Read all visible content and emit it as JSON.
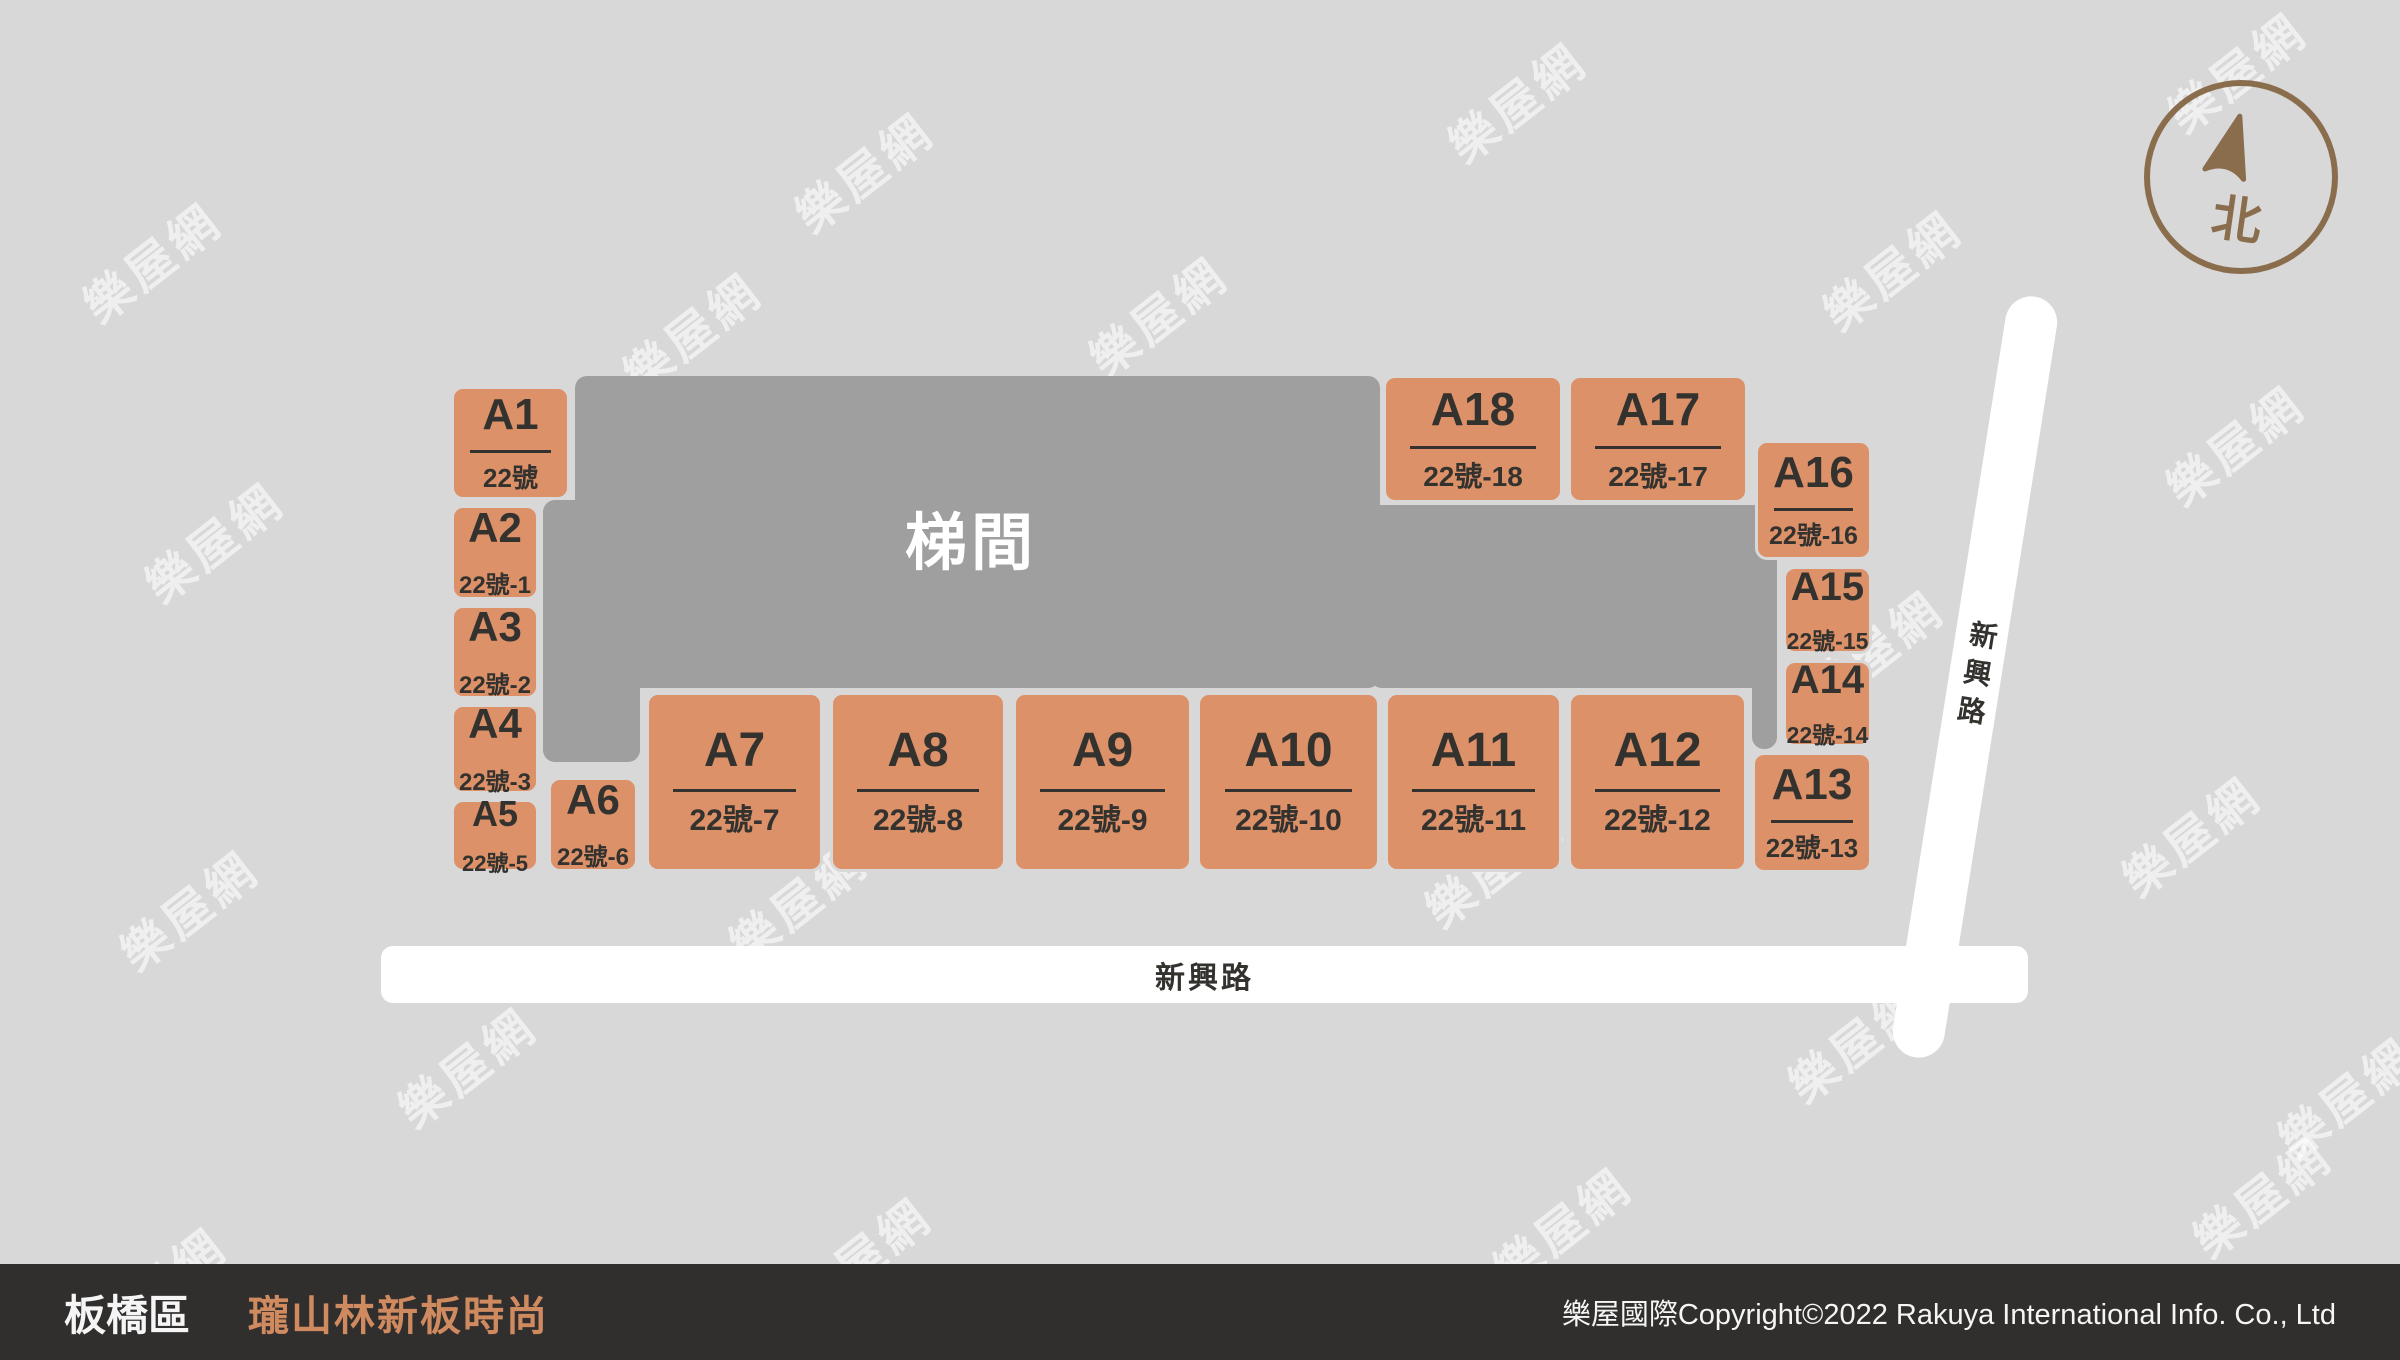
{
  "colors": {
    "bg": "#d8d8d8",
    "stair_fill": "#9f9f9f",
    "stair_text": "#ffffff",
    "unit_fill": "#dd9168",
    "unit_text": "#33322f",
    "road_fill": "#ffffff",
    "road_text": "#33322f",
    "compass_brown": "#8a6d4c",
    "footer_bg": "#302f2d",
    "footer_text": "#f5f5f5",
    "footer_project": "#cf8a60",
    "watermark": "rgba(255,255,255,0.6)"
  },
  "map": {
    "stairwell_label": "梯間",
    "road_bottom": {
      "label": "新興路"
    },
    "road_right": {
      "label": "新興路"
    },
    "compass": {
      "north_label": "北"
    },
    "watermark": {
      "text": "樂屋網",
      "positions": [
        [
          150,
          260
        ],
        [
          862,
          170
        ],
        [
          1515,
          100
        ],
        [
          2235,
          70
        ],
        [
          1890,
          268
        ],
        [
          1156,
          314
        ],
        [
          690,
          330
        ],
        [
          212,
          540
        ],
        [
          2233,
          443
        ],
        [
          1872,
          648
        ],
        [
          187,
          908
        ],
        [
          796,
          900
        ],
        [
          1492,
          865
        ],
        [
          2189,
          834
        ],
        [
          465,
          1065
        ],
        [
          1855,
          1040
        ],
        [
          2345,
          1095
        ],
        [
          155,
          1285
        ],
        [
          860,
          1255
        ],
        [
          1560,
          1225
        ],
        [
          2260,
          1195
        ]
      ]
    },
    "units": [
      {
        "id": "A1",
        "address": "22號",
        "x": 451,
        "y": 386,
        "w": 119,
        "h": 114,
        "fs": 44,
        "afs": 26
      },
      {
        "id": "A2",
        "address": "22號-1",
        "x": 451,
        "y": 505,
        "w": 88,
        "h": 95,
        "fs": 42,
        "afs": 24
      },
      {
        "id": "A3",
        "address": "22號-2",
        "x": 451,
        "y": 605,
        "w": 88,
        "h": 94,
        "fs": 42,
        "afs": 24
      },
      {
        "id": "A4",
        "address": "22號-3",
        "x": 451,
        "y": 704,
        "w": 88,
        "h": 90,
        "fs": 42,
        "afs": 24
      },
      {
        "id": "A5",
        "address": "22號-5",
        "x": 451,
        "y": 799,
        "w": 88,
        "h": 73,
        "fs": 36,
        "afs": 22
      },
      {
        "id": "A6",
        "address": "22號-6",
        "x": 548,
        "y": 777,
        "w": 90,
        "h": 95,
        "fs": 42,
        "afs": 24
      },
      {
        "id": "A7",
        "address": "22號-7",
        "x": 646,
        "y": 692,
        "w": 177,
        "h": 180,
        "fs": 48,
        "afs": 30
      },
      {
        "id": "A8",
        "address": "22號-8",
        "x": 830,
        "y": 692,
        "w": 176,
        "h": 180,
        "fs": 48,
        "afs": 30
      },
      {
        "id": "A9",
        "address": "22號-9",
        "x": 1013,
        "y": 692,
        "w": 179,
        "h": 180,
        "fs": 48,
        "afs": 30
      },
      {
        "id": "A10",
        "address": "22號-10",
        "x": 1197,
        "y": 692,
        "w": 183,
        "h": 180,
        "fs": 48,
        "afs": 30
      },
      {
        "id": "A11",
        "address": "22號-11",
        "x": 1385,
        "y": 692,
        "w": 177,
        "h": 180,
        "fs": 48,
        "afs": 30
      },
      {
        "id": "A12",
        "address": "22號-12",
        "x": 1568,
        "y": 692,
        "w": 179,
        "h": 180,
        "fs": 48,
        "afs": 30
      },
      {
        "id": "A13",
        "address": "22號-13",
        "x": 1752,
        "y": 752,
        "w": 120,
        "h": 121,
        "fs": 44,
        "afs": 26
      },
      {
        "id": "A14",
        "address": "22號-14",
        "x": 1783,
        "y": 660,
        "w": 89,
        "h": 87,
        "fs": 40,
        "afs": 23
      },
      {
        "id": "A15",
        "address": "22號-15",
        "x": 1783,
        "y": 566,
        "w": 89,
        "h": 88,
        "fs": 40,
        "afs": 23
      },
      {
        "id": "A16",
        "address": "22號-16",
        "x": 1755,
        "y": 440,
        "w": 117,
        "h": 120,
        "fs": 44,
        "afs": 25
      },
      {
        "id": "A17",
        "address": "22號-17",
        "x": 1568,
        "y": 375,
        "w": 180,
        "h": 128,
        "fs": 46,
        "afs": 28
      },
      {
        "id": "A18",
        "address": "22號-18",
        "x": 1383,
        "y": 375,
        "w": 180,
        "h": 128,
        "fs": 46,
        "afs": 28
      }
    ]
  },
  "footer": {
    "district": "板橋區",
    "project": "瓏山林新板時尚",
    "copyright": "樂屋國際Copyright©2022 Rakuya International Info. Co., Ltd"
  }
}
